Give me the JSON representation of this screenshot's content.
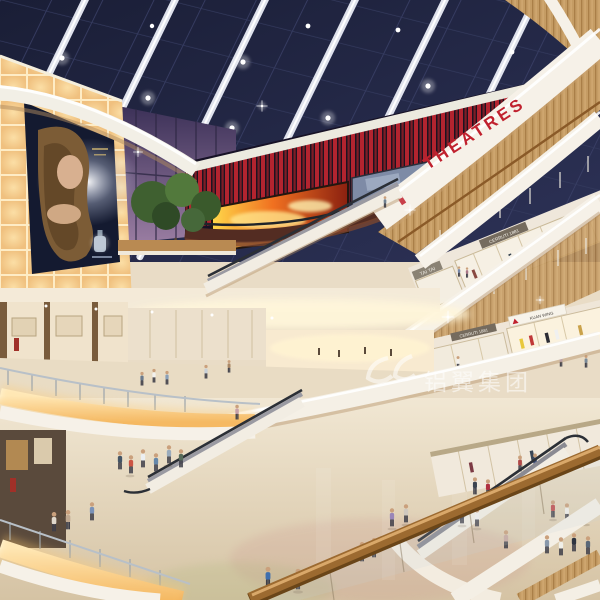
{
  "image": {
    "title": "Shopping mall atrium interior rendering",
    "width": 600,
    "height": 600
  },
  "watermark": {
    "logo": "double-swirl",
    "text": "铝翼集团"
  },
  "signs": {
    "theatres": "THEATRES",
    "tai_tai_upper": "TAI TAI",
    "cerruti_upper": "CERRUTI 1881",
    "tai_tai_lower": "TAI TAI",
    "cerruti_lower": "CERRUTI 1881",
    "kuan_wing": "KUAN WING"
  },
  "palette": {
    "skylight_navy": "#232743",
    "beam_white": "#e3e5ef",
    "fins_red": "#b3242f",
    "theatres_red": "#c0212e",
    "fascia_white": "#f6f1e8",
    "wood_tan": "#c59c64",
    "glow_amber": "#f5c87e",
    "floor_beige": "#e7dac2",
    "dusk_glass_purple": "#6b5a82",
    "tree_green": "#4a6b38",
    "fire_orange": "#f07020",
    "poster_navy": "#141a30"
  }
}
